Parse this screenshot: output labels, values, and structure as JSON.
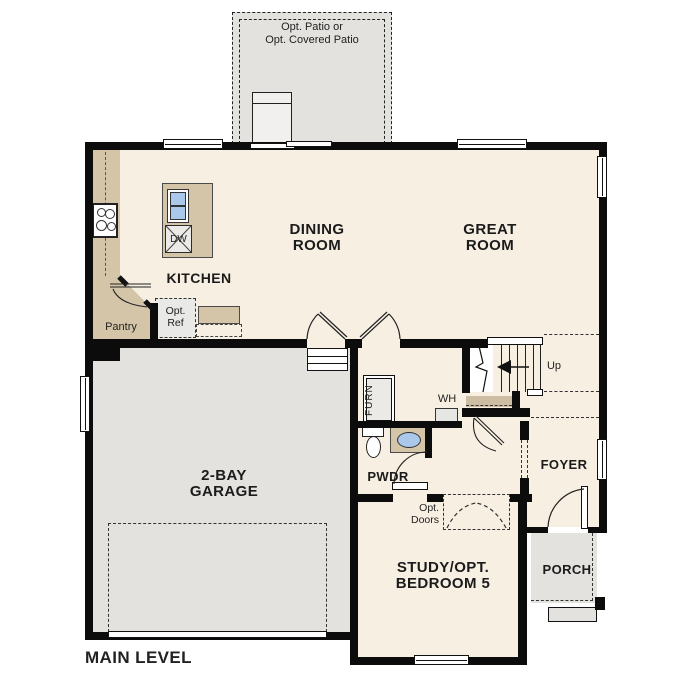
{
  "plan_title": "MAIN LEVEL",
  "patio": {
    "line1": "Opt. Patio or",
    "line2": "Opt. Covered Patio"
  },
  "rooms": {
    "dining_line1": "DINING",
    "dining_line2": "ROOM",
    "great_line1": "GREAT",
    "great_line2": "ROOM",
    "kitchen": "KITCHEN",
    "pantry": "Pantry",
    "garage_line1": "2-BAY",
    "garage_line2": "GARAGE",
    "powder": "PWDR",
    "foyer": "FOYER",
    "porch": "PORCH",
    "study_line1": "STUDY/OPT.",
    "study_line2": "BEDROOM 5"
  },
  "labels": {
    "opt_ref_line1": "Opt.",
    "opt_ref_line2": "Ref",
    "opt_doors_line1": "Opt.",
    "opt_doors_line2": "Doors",
    "dishwasher": "DW",
    "furnace": "FURN",
    "water_heater": "WH",
    "stairs_up": "Up"
  },
  "colors": {
    "floor": "#f7efe2",
    "wall": "#0c0c0c",
    "counter": "#d4c5a8",
    "garage_patio": "#e3e2df",
    "sink": "#aac8ea",
    "closet_shelf": "#cdbda2",
    "appliance": "#eceae7"
  }
}
